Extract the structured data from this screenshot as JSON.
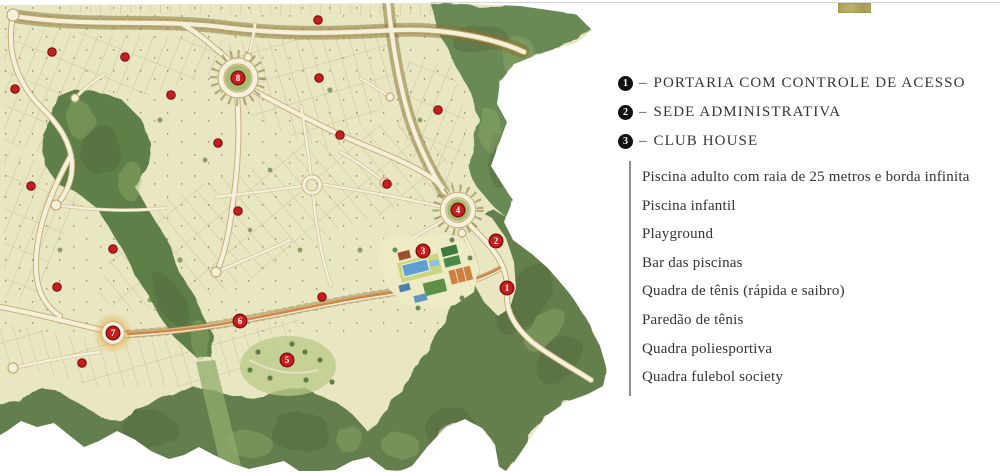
{
  "legend": {
    "separator": "–",
    "items": [
      {
        "number": "1",
        "label": "PORTARIA COM CONTROLE DE ACESSO"
      },
      {
        "number": "2",
        "label": "SEDE ADMINISTRATIVA"
      },
      {
        "number": "3",
        "label": "CLUB HOUSE"
      }
    ]
  },
  "club_house_features": [
    "Piscina adulto com raia de 25 metros e borda infinita",
    "Piscina infantil",
    "Playground",
    "Bar das piscinas",
    "Quadra de tênis (rápida e saibro)",
    "Paredão de tênis",
    "Quadra poliesportiva",
    "Quadra fulebol society"
  ],
  "map": {
    "markers": [
      {
        "id": "1",
        "x": 507,
        "y": 288
      },
      {
        "id": "2",
        "x": 496,
        "y": 241
      },
      {
        "id": "3",
        "x": 423,
        "y": 251
      },
      {
        "id": "4",
        "x": 458,
        "y": 210
      },
      {
        "id": "5",
        "x": 287,
        "y": 360
      },
      {
        "id": "6",
        "x": 240,
        "y": 321
      },
      {
        "id": "7",
        "x": 113,
        "y": 333
      },
      {
        "id": "8",
        "x": 238,
        "y": 78
      }
    ],
    "dots": [
      {
        "x": 52,
        "y": 52
      },
      {
        "x": 125,
        "y": 57
      },
      {
        "x": 15,
        "y": 89
      },
      {
        "x": 171,
        "y": 95
      },
      {
        "x": 218,
        "y": 143
      },
      {
        "x": 31,
        "y": 186
      },
      {
        "x": 113,
        "y": 249
      },
      {
        "x": 57,
        "y": 287
      },
      {
        "x": 238,
        "y": 211
      },
      {
        "x": 318,
        "y": 20
      },
      {
        "x": 319,
        "y": 78
      },
      {
        "x": 340,
        "y": 135
      },
      {
        "x": 387,
        "y": 184
      },
      {
        "x": 438,
        "y": 110
      },
      {
        "x": 82,
        "y": 363
      },
      {
        "x": 322,
        "y": 297
      }
    ],
    "colors": {
      "land": "#e9e6c2",
      "forest": "#6b8751",
      "forest_dark": "#4a663c",
      "road": "#f5f0da",
      "road_casing": "#c2aa78",
      "tree_line": "#7f7134",
      "highlight_road": "#cc7a33",
      "marker_red": "#c81e1e",
      "marker_ring": "#7d0f0f",
      "dot": "#c81e1e",
      "dot_ring": "#821111",
      "pool_blue": "#5f9fd1",
      "clay_orange": "#cd7f3f",
      "court_green": "#3e7a3e",
      "legend_text": "#343434",
      "logo_khaki": "#b2a75f"
    }
  }
}
